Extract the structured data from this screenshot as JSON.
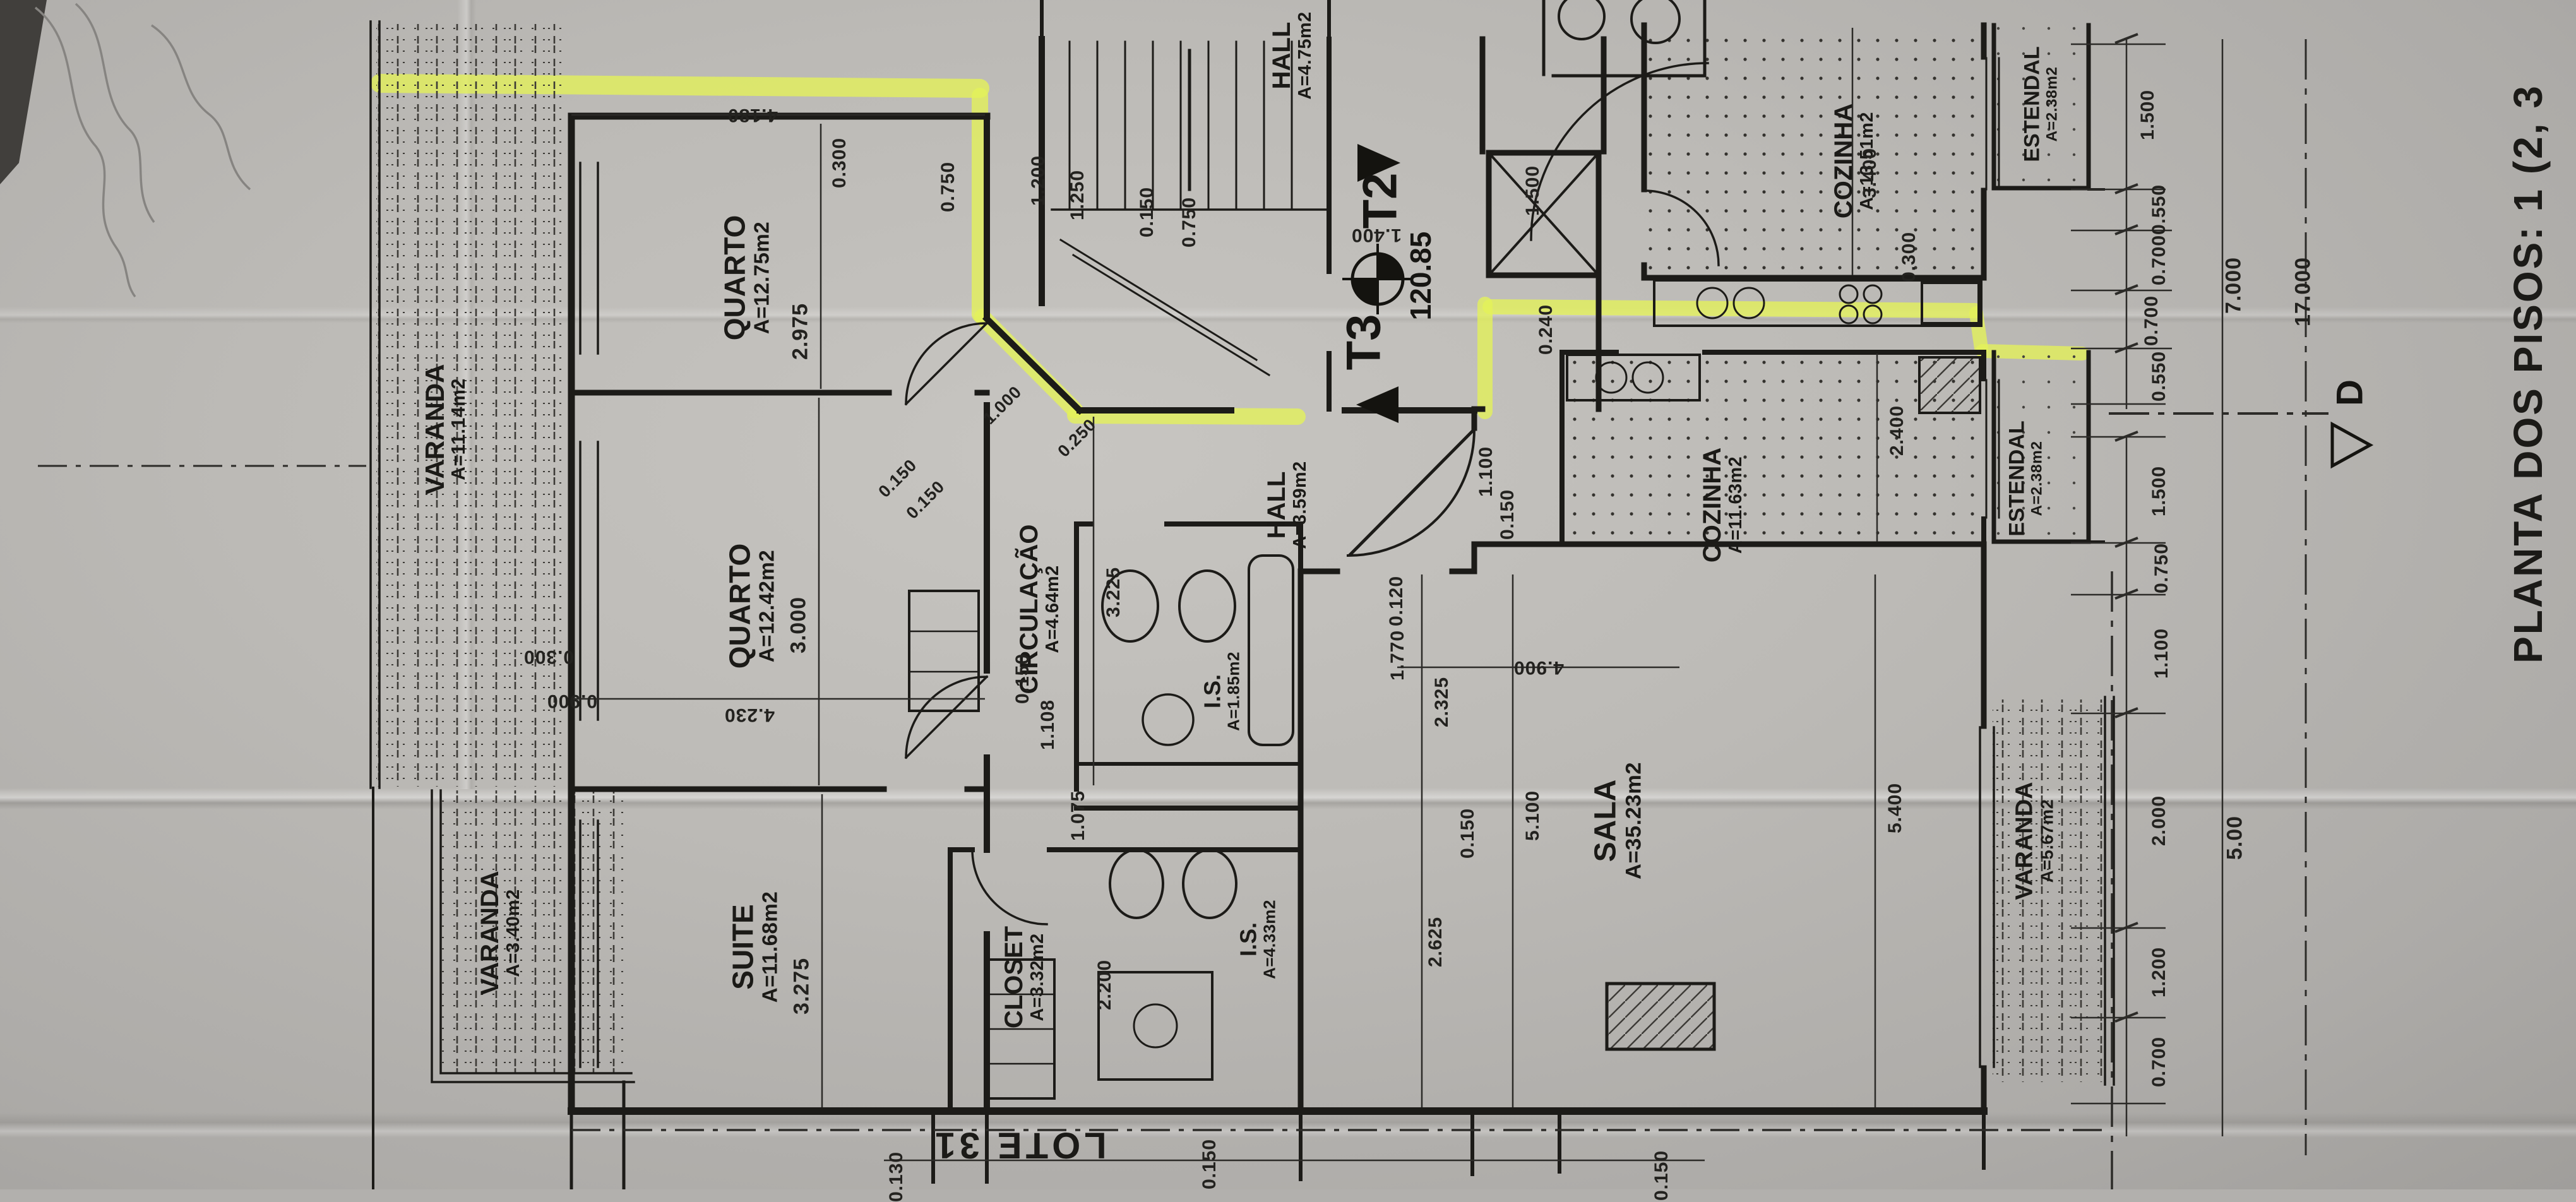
{
  "sheet": {
    "title": "PLANTA DOS PISOS: 1 (2, 3",
    "lot_label": "LOTE 31"
  },
  "markers": {
    "unit_t2": "T2",
    "unit_t3": "T3",
    "elevation": "120.85",
    "section_letter": "D",
    "level_target_icon": "level-target-icon",
    "highlight_color": "#e4f258"
  },
  "rooms": {
    "varanda_tl": {
      "name": "VARANDA",
      "area": "A=11.14m2"
    },
    "quarto1": {
      "name": "QUARTO",
      "area": "A=12.75m2"
    },
    "quarto2": {
      "name": "QUARTO",
      "area": "A=12.42m2"
    },
    "suite": {
      "name": "SUITE",
      "area": "A=11.68m2"
    },
    "varanda_bl": {
      "name": "VARANDA",
      "area": "A=3.40m2"
    },
    "closet": {
      "name": "CLOSET",
      "area": "A=3.32m2"
    },
    "circulacao": {
      "name": "CIRCULAÇÃO",
      "area": "A=4.64m2"
    },
    "is1": {
      "name": "I.S.",
      "area": "A=1.85m2"
    },
    "is2": {
      "name": "I.S.",
      "area": "A=4.33m2"
    },
    "hall": {
      "name": "HALL",
      "area": "A=3.59m2"
    },
    "hall_top": {
      "name": "HALL",
      "area": "A=4.75m2"
    },
    "cozinha1": {
      "name": "COZINHA",
      "area": "A=13.51m2"
    },
    "cozinha2": {
      "name": "COZINHA",
      "area": "A=11.63m2"
    },
    "estendal1": {
      "name": "ESTENDAL",
      "area": "A=2.38m2"
    },
    "estendal2": {
      "name": "ESTENDAL",
      "area": "A=2.38m2"
    },
    "sala": {
      "name": "SALA",
      "area": "A=35.23m2"
    },
    "varanda_r": {
      "name": "VARANDA",
      "area": "A=5.67m2"
    }
  },
  "dims": [
    "4.180",
    "0.300",
    "2.975",
    "3.000",
    "4.230",
    "3.275",
    "0.150",
    "1.108",
    "3.225",
    "0.750",
    "1.200",
    "1.250",
    "0.150",
    "0.750",
    "1.400",
    "1.500",
    "0.250",
    "1.000",
    "0.150",
    "0.150",
    "2.325",
    "1.770",
    "0.120",
    "2.625",
    "5.100",
    "0.150",
    "4.900",
    "5.400",
    "1.100",
    "0.150",
    "0.240",
    "2.400",
    "3.400",
    "0.300",
    "2.200",
    "1.075",
    "0.300",
    "0.900",
    "1.500",
    "0.550",
    "0.700",
    "0.700",
    "0.550",
    "7.000",
    "17.000",
    "1.500",
    "0.750",
    "1.100",
    "2.000",
    "5.00",
    "1.200",
    "0.700",
    "0.150",
    "0.150",
    "0.130"
  ]
}
